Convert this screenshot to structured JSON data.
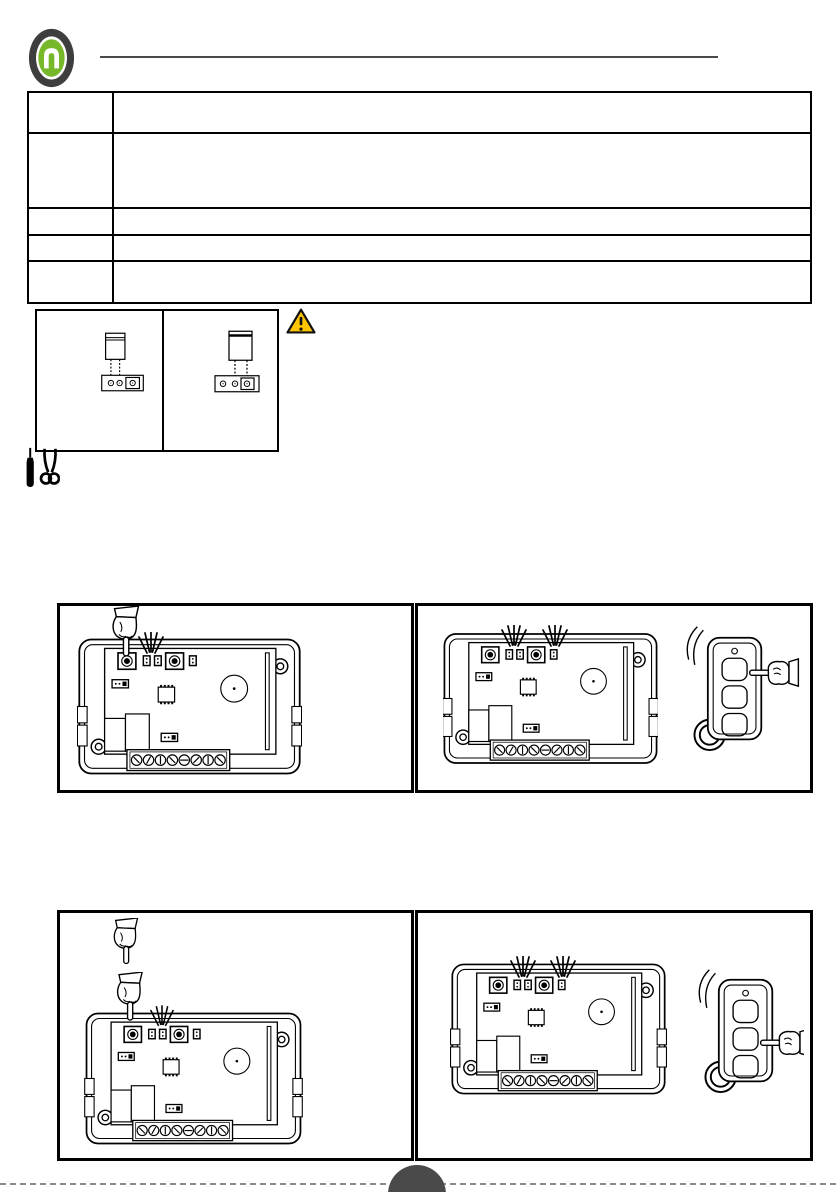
{
  "page": {
    "width": 840,
    "height": 1192,
    "background": "#ffffff"
  },
  "header": {
    "logo": {
      "icon": "brand-logo",
      "ring_color": "#3e3e3e",
      "disc_color": "#76b82a",
      "glyph": "arch-n",
      "glyph_color": "#ffffff"
    },
    "rule_color": "#4a4a4a"
  },
  "spec_table": {
    "rows": [
      {
        "col1": "",
        "col2": ""
      },
      {
        "col1": "",
        "col2": ""
      },
      {
        "col1": "",
        "col2": ""
      },
      {
        "col1": "",
        "col2": ""
      },
      {
        "col1": "",
        "col2": ""
      }
    ]
  },
  "jumper_figure": {
    "cells": [
      {
        "icon": "jumper-cap-on-pins-1-2"
      },
      {
        "icon": "jumper-cap-on-pins-2-3"
      }
    ],
    "warning": {
      "icon": "warning-triangle-icon",
      "fill": "#ffc400",
      "border": "#111111"
    }
  },
  "cut_tools": {
    "icon": "marker-and-scissors-icon"
  },
  "figures": [
    {
      "id": "step-1",
      "board": {
        "hand": "press-left-button",
        "blinking_leds": [
          1,
          2
        ],
        "buttons": 2,
        "leds": 3
      },
      "remote": null
    },
    {
      "id": "step-2",
      "board": {
        "hand": null,
        "blinking_leds": [
          1,
          2,
          3
        ],
        "buttons": 2,
        "leds": 3
      },
      "remote": {
        "hand_points_at": "top-button",
        "waves": true,
        "buttons": 3
      }
    },
    {
      "id": "step-3",
      "board": {
        "hand": "double-press-left-button",
        "blinking_leds": [
          2
        ],
        "buttons": 2,
        "leds": 3
      },
      "remote": null
    },
    {
      "id": "step-4",
      "board": {
        "hand": null,
        "blinking_leds": [
          1,
          2,
          3
        ],
        "buttons": 2,
        "leds": 3
      },
      "remote": {
        "hand_points_at": "middle-button",
        "waves": true,
        "buttons": 3
      }
    }
  ],
  "footer": {
    "cut_line_style": "dashed",
    "page_badge": {
      "color": "#4a4a4a",
      "label": ""
    }
  }
}
